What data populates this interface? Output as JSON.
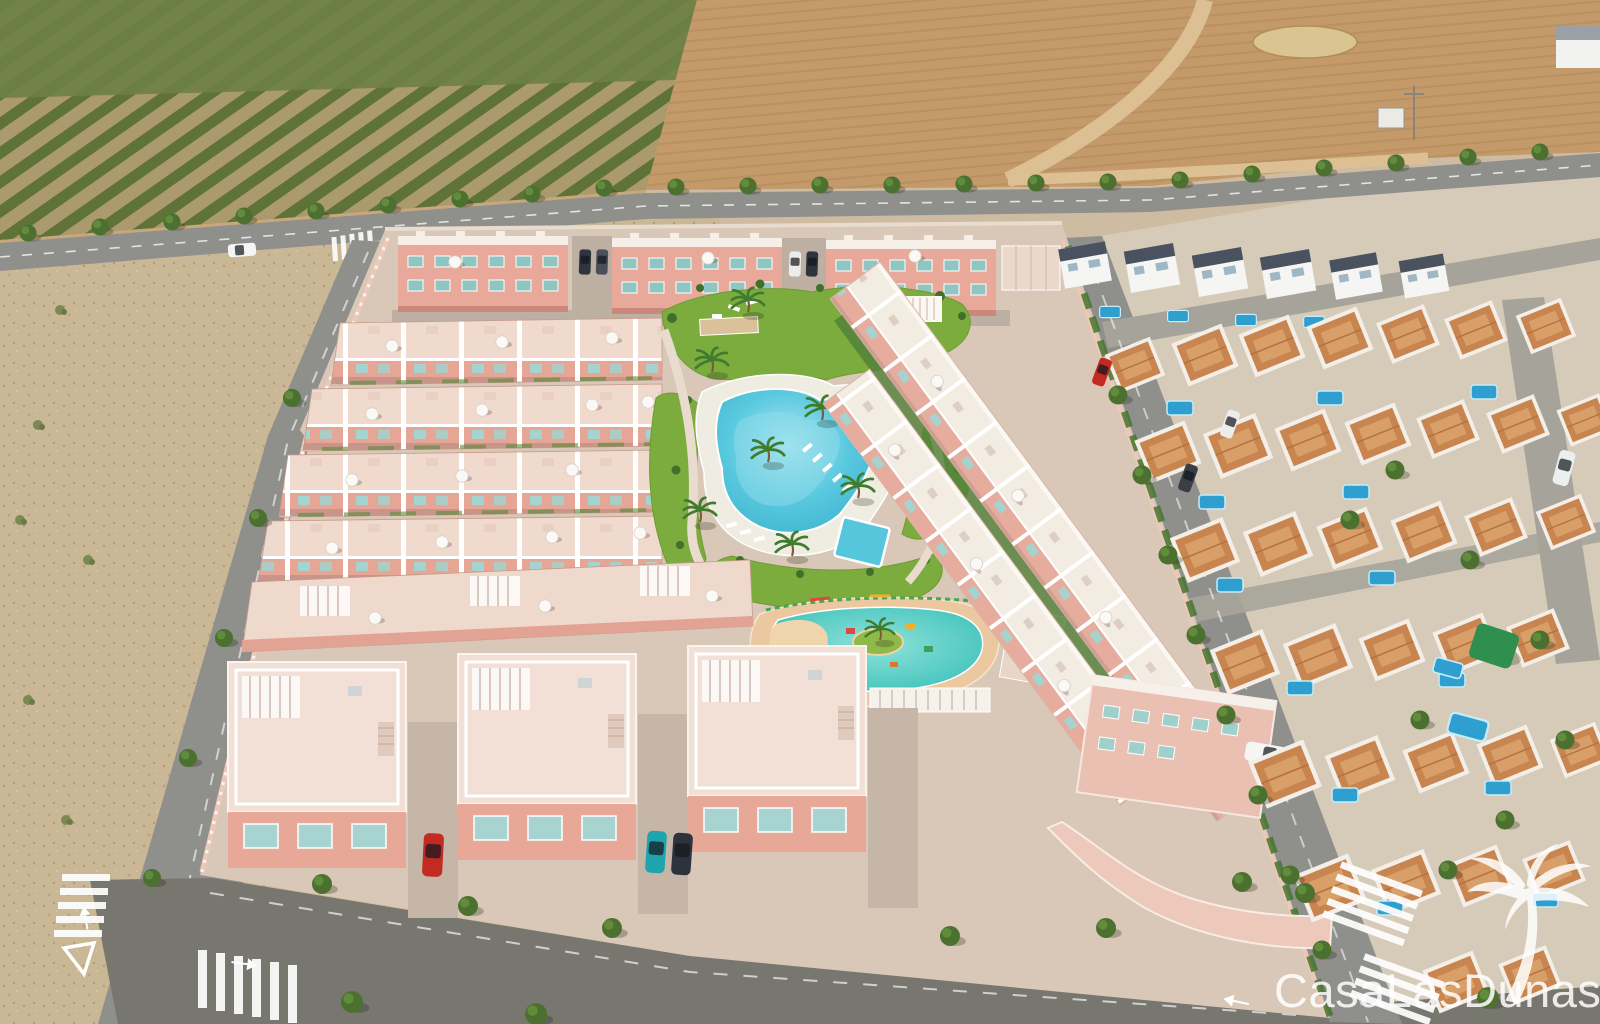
{
  "watermark": {
    "brand": "CasaLasDunas",
    "logo_icon": "palm-tree-icon"
  },
  "palette": {
    "sand_base": "#cdbca2",
    "orchard_tan": "#ab9a6e",
    "orchard_green": "#5f7339",
    "orchard_scrub": "#6d7f45",
    "field_brown": "#c49a6a",
    "field_track": "#dcc094",
    "straw": "#d9c492",
    "road_gray": "#8f8f8c",
    "road_light": "#a6a49a",
    "road_dark": "#77766f",
    "scrub_sand": "#c9b795",
    "pavement": "#d9c7b7",
    "pink_wall": "#ecc8b8",
    "pink_facade": "#e5a696",
    "pink_light": "#f0d9cd",
    "teal_glass": "#a5d3cf",
    "lawn": "#7cac3e",
    "hedge": "#41702c",
    "beach_deck": "#efece1",
    "pool_water": "#55c6dc",
    "kids_water": "#3ec6be",
    "kids_deck": "#ecc8a1",
    "island_sand": "#f0d4ab",
    "nbhd_base": "#d6cbb8",
    "terracotta": "#c8854f",
    "terracotta_light": "#d89f69",
    "modern_roof": "#49525e",
    "pool_blue": "#2f9fd0",
    "white": "#f7f5f1",
    "car_red": "#c22a22",
    "car_teal": "#1fa3ad",
    "car_dark": "#2e323c",
    "car_white": "#f5f5f3",
    "watermark_white": "#ffffff"
  }
}
